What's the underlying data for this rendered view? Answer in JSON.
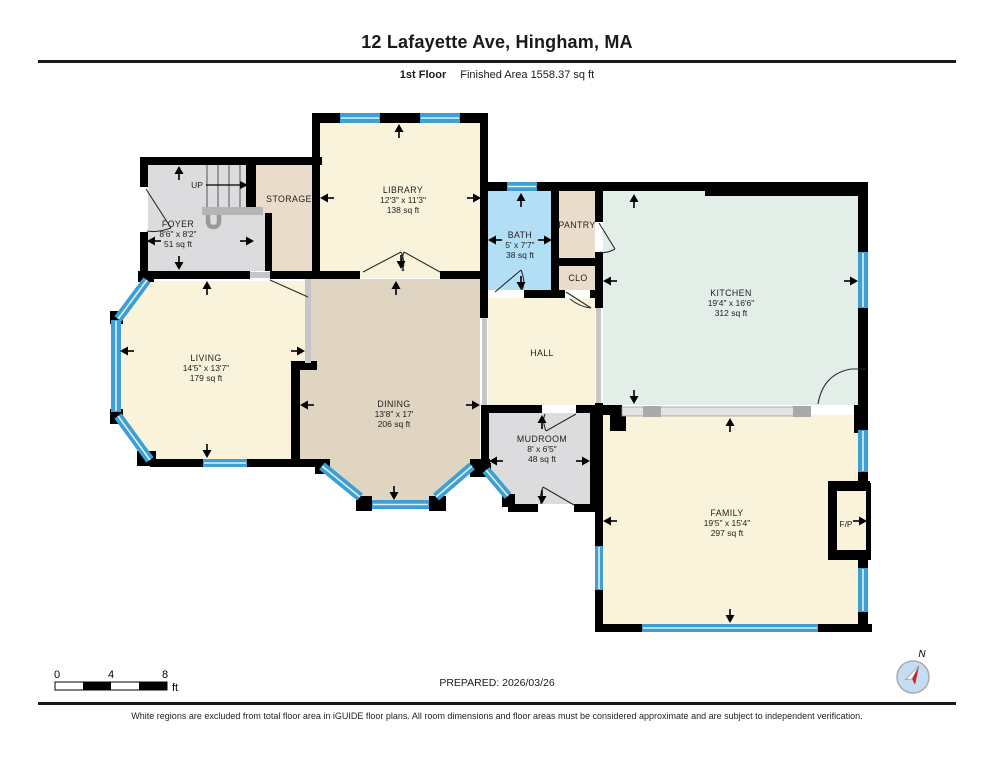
{
  "header": {
    "title": "12 Lafayette Ave, Hingham, MA",
    "floor_label": "1st Floor",
    "area_label": "Finished Area 1558.37 sq ft"
  },
  "rooms": {
    "foyer": {
      "name": "FOYER",
      "dims": "8'6\" x 8'2\"",
      "area": "51 sq ft"
    },
    "storage": {
      "name": "STORAGE"
    },
    "library": {
      "name": "LIBRARY",
      "dims": "12'3\" x 11'3\"",
      "area": "138 sq ft"
    },
    "bath": {
      "name": "BATH",
      "dims": "5' x 7'7\"",
      "area": "38 sq ft"
    },
    "pantry": {
      "name": "PANTRY"
    },
    "closet": {
      "name": "CLO"
    },
    "kitchen": {
      "name": "KITCHEN",
      "dims": "19'4\" x 16'6\"",
      "area": "312 sq ft"
    },
    "living": {
      "name": "LIVING",
      "dims": "14'5\" x 13'7\"",
      "area": "179 sq ft"
    },
    "dining": {
      "name": "DINING",
      "dims": "13'8\" x 17'",
      "area": "206 sq ft"
    },
    "hall": {
      "name": "HALL"
    },
    "mudroom": {
      "name": "MUDROOM",
      "dims": "8' x 6'5\"",
      "area": "48 sq ft"
    },
    "family": {
      "name": "FAMILY",
      "dims": "19'5\" x 15'4\"",
      "area": "297 sq ft"
    },
    "fireplace": {
      "name": "F/P"
    }
  },
  "stairs": {
    "label": "UP"
  },
  "scale_bar": {
    "t0": "0",
    "t4": "4",
    "t8": "8",
    "unit": "ft"
  },
  "footer": {
    "prepared": "PREPARED: 2026/03/26",
    "compass_north": "N",
    "disclaimer": "White regions are excluded from total floor area in iGUIDE floor plans. All room dimensions and floor areas must be considered approximate and are subject to independent verification."
  },
  "colors": {
    "wall": "#000000",
    "window_blue": "#3d9fd3",
    "bath_blue": "#b3dff6",
    "kitchen_mint": "#e2eee7",
    "cream": "#faf3dc",
    "dining_tan": "#e0d5c2",
    "storage_tan": "#e9dccb",
    "gray_floor": "#dcdcde",
    "opening_gray": "#c6c6c8",
    "compass_red": "#cc2222"
  }
}
